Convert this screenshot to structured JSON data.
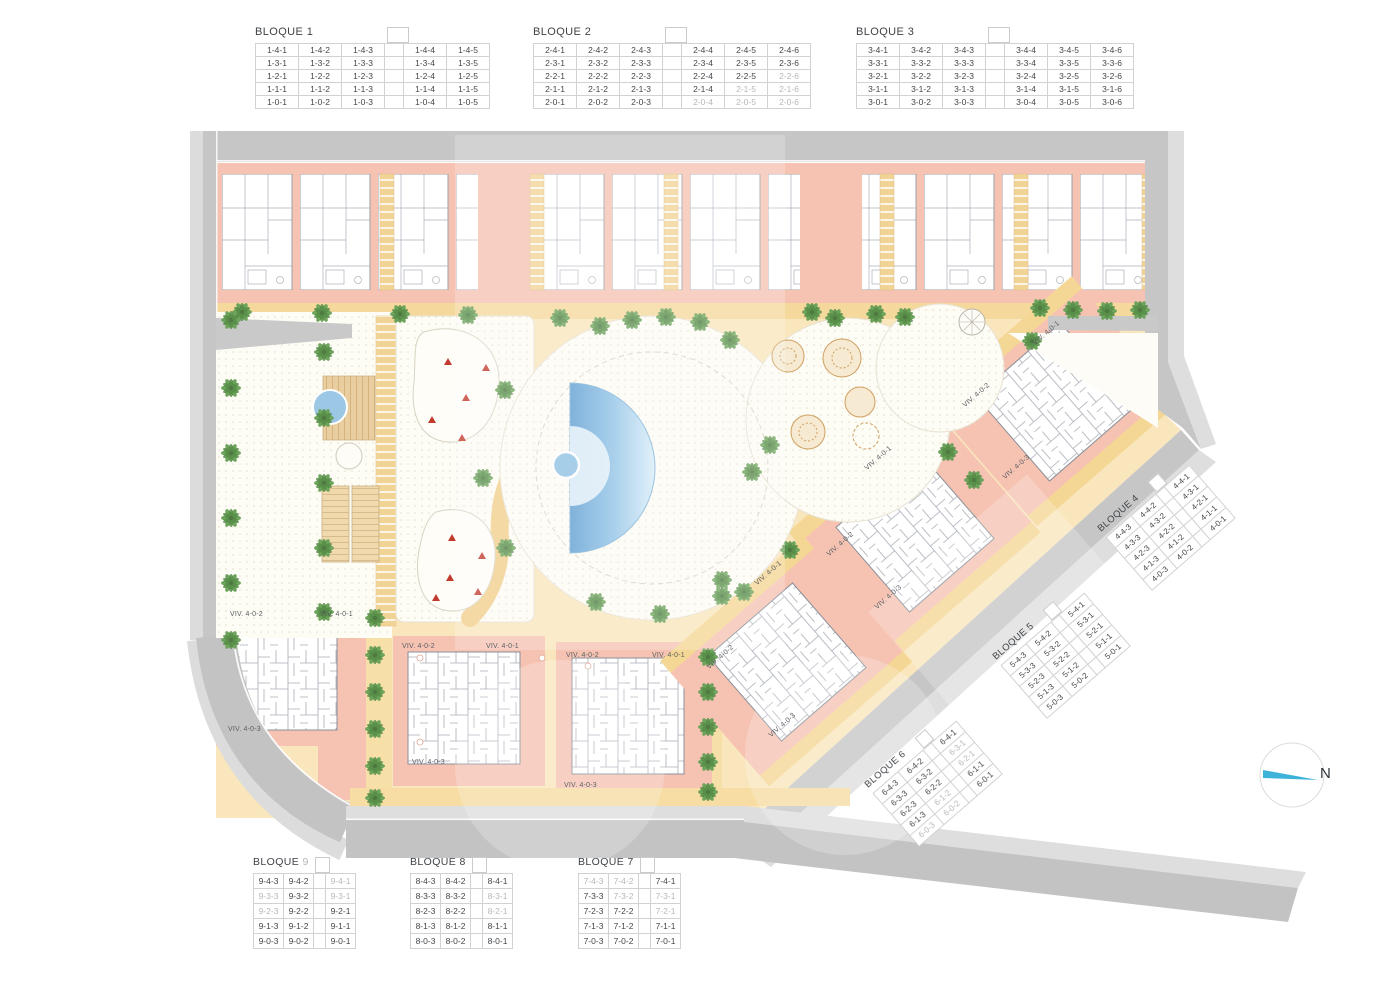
{
  "plan": {
    "compass_label": "N",
    "viv": {
      "v1": "VIV. 4-0-1",
      "v2": "VIV. 4-0-2",
      "v3": "VIV. 4-0-3"
    }
  },
  "blocks": [
    {
      "title": "BLOQUE",
      "number": "1",
      "gap_after": 3,
      "grey": [],
      "rows": [
        [
          "1-4-1",
          "1-4-2",
          "1-4-3",
          "1-4-4",
          "1-4-5"
        ],
        [
          "1-3-1",
          "1-3-2",
          "1-3-3",
          "1-3-4",
          "1-3-5"
        ],
        [
          "1-2-1",
          "1-2-2",
          "1-2-3",
          "1-2-4",
          "1-2-5"
        ],
        [
          "1-1-1",
          "1-1-2",
          "1-1-3",
          "1-1-4",
          "1-1-5"
        ],
        [
          "1-0-1",
          "1-0-2",
          "1-0-3",
          "1-0-4",
          "1-0-5"
        ]
      ]
    },
    {
      "title": "BLOQUE",
      "number": "2",
      "gap_after": 3,
      "grey": [
        "2-2-6",
        "2-1-5",
        "2-1-6",
        "2-0-4",
        "2-0-5",
        "2-0-6"
      ],
      "rows": [
        [
          "2-4-1",
          "2-4-2",
          "2-4-3",
          "2-4-4",
          "2-4-5",
          "2-4-6"
        ],
        [
          "2-3-1",
          "2-3-2",
          "2-3-3",
          "2-3-4",
          "2-3-5",
          "2-3-6"
        ],
        [
          "2-2-1",
          "2-2-2",
          "2-2-3",
          "2-2-4",
          "2-2-5",
          "2-2-6"
        ],
        [
          "2-1-1",
          "2-1-2",
          "2-1-3",
          "2-1-4",
          "2-1-5",
          "2-1-6"
        ],
        [
          "2-0-1",
          "2-0-2",
          "2-0-3",
          "2-0-4",
          "2-0-5",
          "2-0-6"
        ]
      ]
    },
    {
      "title": "BLOQUE",
      "number": "3",
      "gap_after": 3,
      "grey": [],
      "rows": [
        [
          "3-4-1",
          "3-4-2",
          "3-4-3",
          "3-4-4",
          "3-4-5",
          "3-4-6"
        ],
        [
          "3-3-1",
          "3-3-2",
          "3-3-3",
          "3-3-4",
          "3-3-5",
          "3-3-6"
        ],
        [
          "3-2-1",
          "3-2-2",
          "3-2-3",
          "3-2-4",
          "3-2-5",
          "3-2-6"
        ],
        [
          "3-1-1",
          "3-1-2",
          "3-1-3",
          "3-1-4",
          "3-1-5",
          "3-1-6"
        ],
        [
          "3-0-1",
          "3-0-2",
          "3-0-3",
          "3-0-4",
          "3-0-5",
          "3-0-6"
        ]
      ]
    },
    {
      "title": "BLOQUE",
      "number": "4",
      "gap_after": 2,
      "grey": [],
      "rows": [
        [
          "4-4-3",
          "4-4-2",
          "4-4-1"
        ],
        [
          "4-3-3",
          "4-3-2",
          "4-3-1"
        ],
        [
          "4-2-3",
          "4-2-2",
          "4-2-1"
        ],
        [
          "4-1-3",
          "4-1-2",
          "4-1-1"
        ],
        [
          "4-0-3",
          "4-0-2",
          "4-0-1"
        ]
      ]
    },
    {
      "title": "BLOQUE",
      "number": "5",
      "gap_after": 2,
      "grey": [],
      "rows": [
        [
          "5-4-3",
          "5-4-2",
          "5-4-1"
        ],
        [
          "5-3-3",
          "5-3-2",
          "5-3-1"
        ],
        [
          "5-2-3",
          "5-2-2",
          "5-2-1"
        ],
        [
          "5-1-3",
          "5-1-2",
          "5-1-1"
        ],
        [
          "5-0-3",
          "5-0-2",
          "5-0-1"
        ]
      ]
    },
    {
      "title": "BLOQUE",
      "number": "6",
      "gap_after": 2,
      "grey": [
        "6-3-1",
        "6-2-1",
        "6-1-2",
        "6-0-3",
        "6-0-2"
      ],
      "rows": [
        [
          "6-4-3",
          "6-4-2",
          "6-4-1"
        ],
        [
          "6-3-3",
          "6-3-2",
          "6-3-1"
        ],
        [
          "6-2-3",
          "6-2-2",
          "6-2-1"
        ],
        [
          "6-1-3",
          "6-1-2",
          "6-1-1"
        ],
        [
          "6-0-3",
          "6-0-2",
          "6-0-1"
        ]
      ]
    },
    {
      "title": "BLOQUE",
      "number": "7",
      "gap_after": 2,
      "grey": [
        "7-4-3",
        "7-4-2",
        "7-3-2",
        "7-3-1",
        "7-2-1"
      ],
      "rows": [
        [
          "7-4-3",
          "7-4-2",
          "7-4-1"
        ],
        [
          "7-3-3",
          "7-3-2",
          "7-3-1"
        ],
        [
          "7-2-3",
          "7-2-2",
          "7-2-1"
        ],
        [
          "7-1-3",
          "7-1-2",
          "7-1-1"
        ],
        [
          "7-0-3",
          "7-0-2",
          "7-0-1"
        ]
      ]
    },
    {
      "title": "BLOQUE",
      "number": "8",
      "gap_after": 2,
      "grey": [
        "8-3-1",
        "8-2-1"
      ],
      "rows": [
        [
          "8-4-3",
          "8-4-2",
          "8-4-1"
        ],
        [
          "8-3-3",
          "8-3-2",
          "8-3-1"
        ],
        [
          "8-2-3",
          "8-2-2",
          "8-2-1"
        ],
        [
          "8-1-3",
          "8-1-2",
          "8-1-1"
        ],
        [
          "8-0-3",
          "8-0-2",
          "8-0-1"
        ]
      ]
    },
    {
      "title": "BLOQUE",
      "number": "9",
      "gap_after": 2,
      "number_grey": true,
      "grey": [
        "9-4-1",
        "9-3-3",
        "9-3-1",
        "9-2-3"
      ],
      "rows": [
        [
          "9-4-3",
          "9-4-2",
          "9-4-1"
        ],
        [
          "9-3-3",
          "9-3-2",
          "9-3-1"
        ],
        [
          "9-2-3",
          "9-2-2",
          "9-2-1"
        ],
        [
          "9-1-3",
          "9-1-2",
          "9-1-1"
        ],
        [
          "9-0-3",
          "9-0-2",
          "9-0-1"
        ]
      ]
    }
  ]
}
